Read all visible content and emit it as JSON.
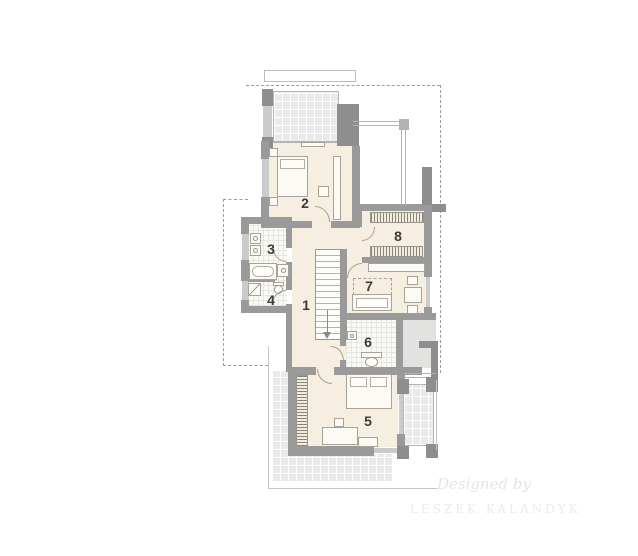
{
  "plan": {
    "type": "residential-floor-plan-upper-storey",
    "rooms": [
      {
        "number": "1"
      },
      {
        "number": "2"
      },
      {
        "number": "3"
      },
      {
        "number": "4"
      },
      {
        "number": "5"
      },
      {
        "number": "6"
      },
      {
        "number": "7"
      },
      {
        "number": "8"
      }
    ],
    "watermark": {
      "line1": "Designed by",
      "line2": "LESZEK KALANDYK"
    },
    "colors": {
      "wall": "#9a9a9a",
      "wall_dark": "#8e8e8e",
      "window": "#cbcbcb",
      "floor": "#f6eee0",
      "tile_bath": "#f9f9f6",
      "tile_terrace": "#eaeaea",
      "line": "#a8a396",
      "dash": "#9c9c9c",
      "label": "#3b3b3b",
      "watermark": "#e8e5df"
    }
  }
}
